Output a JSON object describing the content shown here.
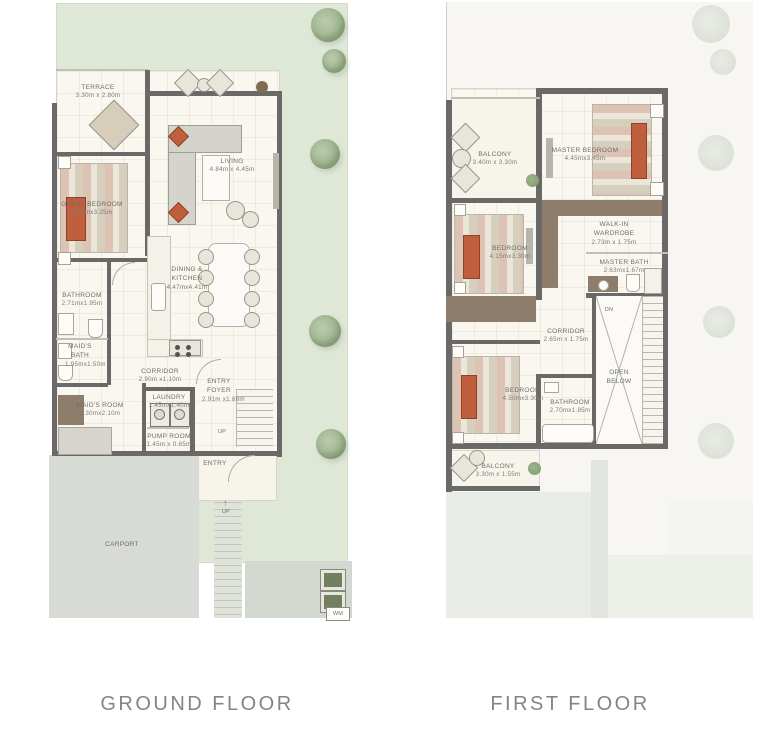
{
  "captions": {
    "ground": "GROUND FLOOR",
    "first": "FIRST FLOOR"
  },
  "ground_floor": {
    "rooms": {
      "terrace": {
        "name": "TERRACE",
        "dims": "3.30m x 2.80m"
      },
      "guest_bedroom": {
        "name": "GUEST BEDROOM",
        "dims": "4.40mx3.25m"
      },
      "living": {
        "name": "LIVING",
        "dims": "4.84m x 4.45m"
      },
      "dining_kitchen": {
        "name": "DINING & KITCHEN",
        "dims": "4.47mx4.41m"
      },
      "bathroom": {
        "name": "BATHROOM",
        "dims": "2.71mx1.95m"
      },
      "maids_bath": {
        "name": "MAID'S BATH",
        "dims": "1.95mx1.50m"
      },
      "corridor": {
        "name": "CORRIDOR",
        "dims": "2.90m x1.10m"
      },
      "maids_room": {
        "name": "MAID'S ROOM",
        "dims": "3.30mx2.10m"
      },
      "laundry": {
        "name": "LAUNDRY",
        "dims": "1.45mx1.40m"
      },
      "pump_room": {
        "name": "PUMP ROOM",
        "dims": "1.45m x 0.65m"
      },
      "entry_foyer": {
        "name": "ENTRY FOYER",
        "dims": "2.91m x1.88m"
      },
      "entry": {
        "name": "ENTRY"
      },
      "carport": {
        "name": "CARPORT"
      }
    },
    "annotations": {
      "up_stairs": "UP",
      "up_walkway": "UP",
      "wm": "WM"
    }
  },
  "first_floor": {
    "rooms": {
      "balcony_top": {
        "name": "BALCONY",
        "dims": "3.40m x 3.30m"
      },
      "master_bedroom": {
        "name": "MASTER BEDROOM",
        "dims": "4.45mx3.45m"
      },
      "bedroom_mid": {
        "name": "BEDROOM",
        "dims": "4.15mx3.30m"
      },
      "walk_in_wardrobe": {
        "name": "WALK-IN WARDROBE",
        "dims": "2.73m x 1.75m"
      },
      "master_bath": {
        "name": "MASTER BATH",
        "dims": "2.63mx1.67m"
      },
      "corridor": {
        "name": "CORRIDOR",
        "dims": "2.65m x 1.75m"
      },
      "bedroom_bottom": {
        "name": "BEDROOM",
        "dims": "4.50mx3.30m"
      },
      "bathroom": {
        "name": "BATHROOM",
        "dims": "2.70mx1.85m"
      },
      "open_below": {
        "name": "OPEN BELOW"
      },
      "balcony_bottom": {
        "name": "BALCONY",
        "dims": "3.30m x 1.55m"
      }
    },
    "annotations": {
      "dn": "DN"
    }
  },
  "colors": {
    "garden_green": "#dfe8d7",
    "wall_dark": "#6b6968",
    "room_cream": "#f9f7f0",
    "carport_gray": "#d8dbd5",
    "roof_gray": "#e9ebe6",
    "wood_brown": "#8d7d6a",
    "accent_terracotta": "#bf5f3d",
    "caption_text": "#85857d"
  }
}
